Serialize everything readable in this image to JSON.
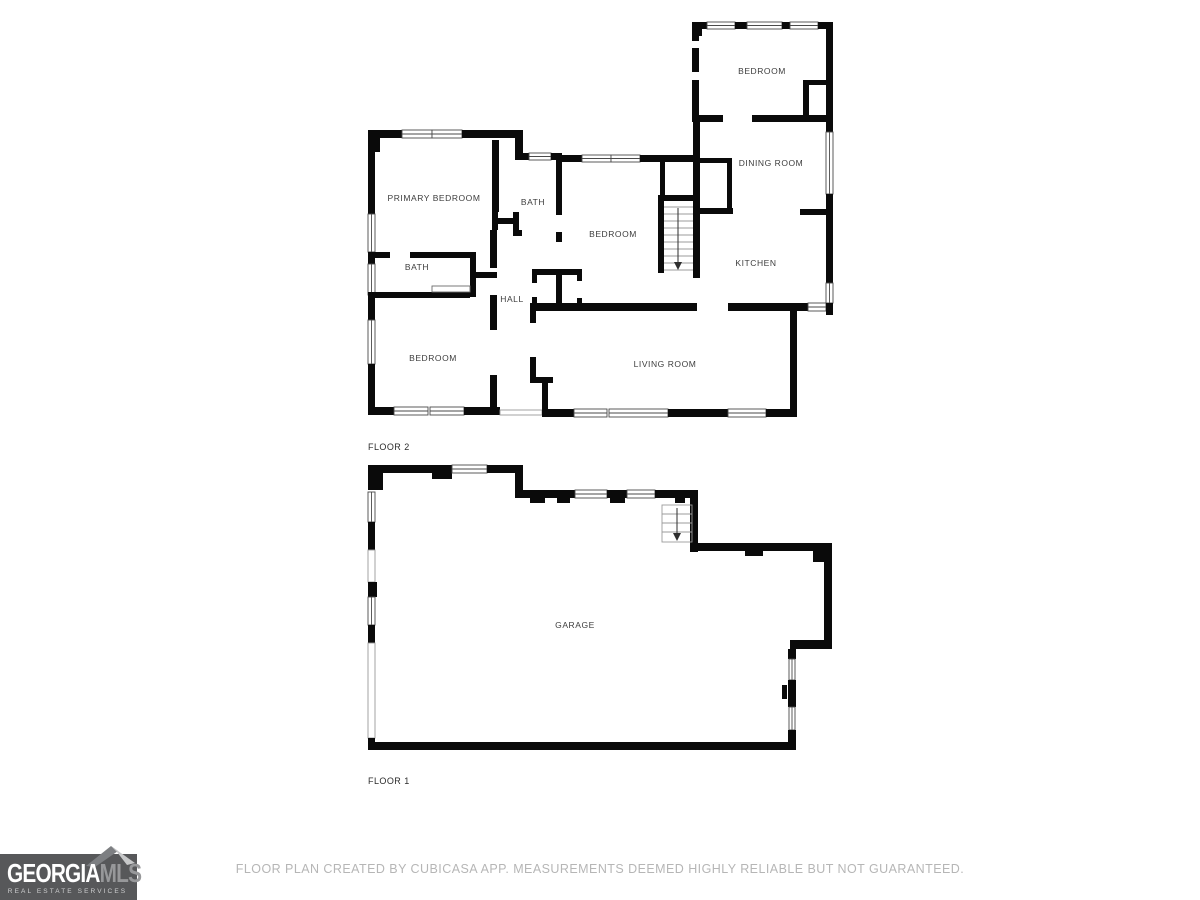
{
  "colors": {
    "wall": "#0a0a0a",
    "label": "#3d3d3d",
    "footer_text": "#b6b6b6",
    "logo_background": "#57585a",
    "logo_primary_text": "#ffffff",
    "logo_secondary_text": "#97989a",
    "roof_dark": "#7d7f82",
    "roof_light": "#c7c8c9"
  },
  "floor2": {
    "name": "FLOOR 2",
    "rooms": [
      {
        "label": "BEDROOM"
      },
      {
        "label": "DINING ROOM"
      },
      {
        "label": "KITCHEN"
      },
      {
        "label": "PRIMARY BEDROOM"
      },
      {
        "label": "BATH"
      },
      {
        "label": "BEDROOM"
      },
      {
        "label": "BATH"
      },
      {
        "label": "HALL"
      },
      {
        "label": "BEDROOM"
      },
      {
        "label": "LIVING ROOM"
      }
    ]
  },
  "floor1": {
    "name": "FLOOR 1",
    "rooms": [
      {
        "label": "GARAGE"
      }
    ]
  },
  "footer": {
    "disclaimer": "FLOOR PLAN CREATED BY CUBICASA APP. MEASUREMENTS DEEMED HIGHLY RELIABLE BUT NOT GUARANTEED."
  },
  "logo": {
    "brand_primary": "GEORGIA",
    "brand_secondary": "MLS",
    "tagline": "REAL ESTATE SERVICES"
  }
}
